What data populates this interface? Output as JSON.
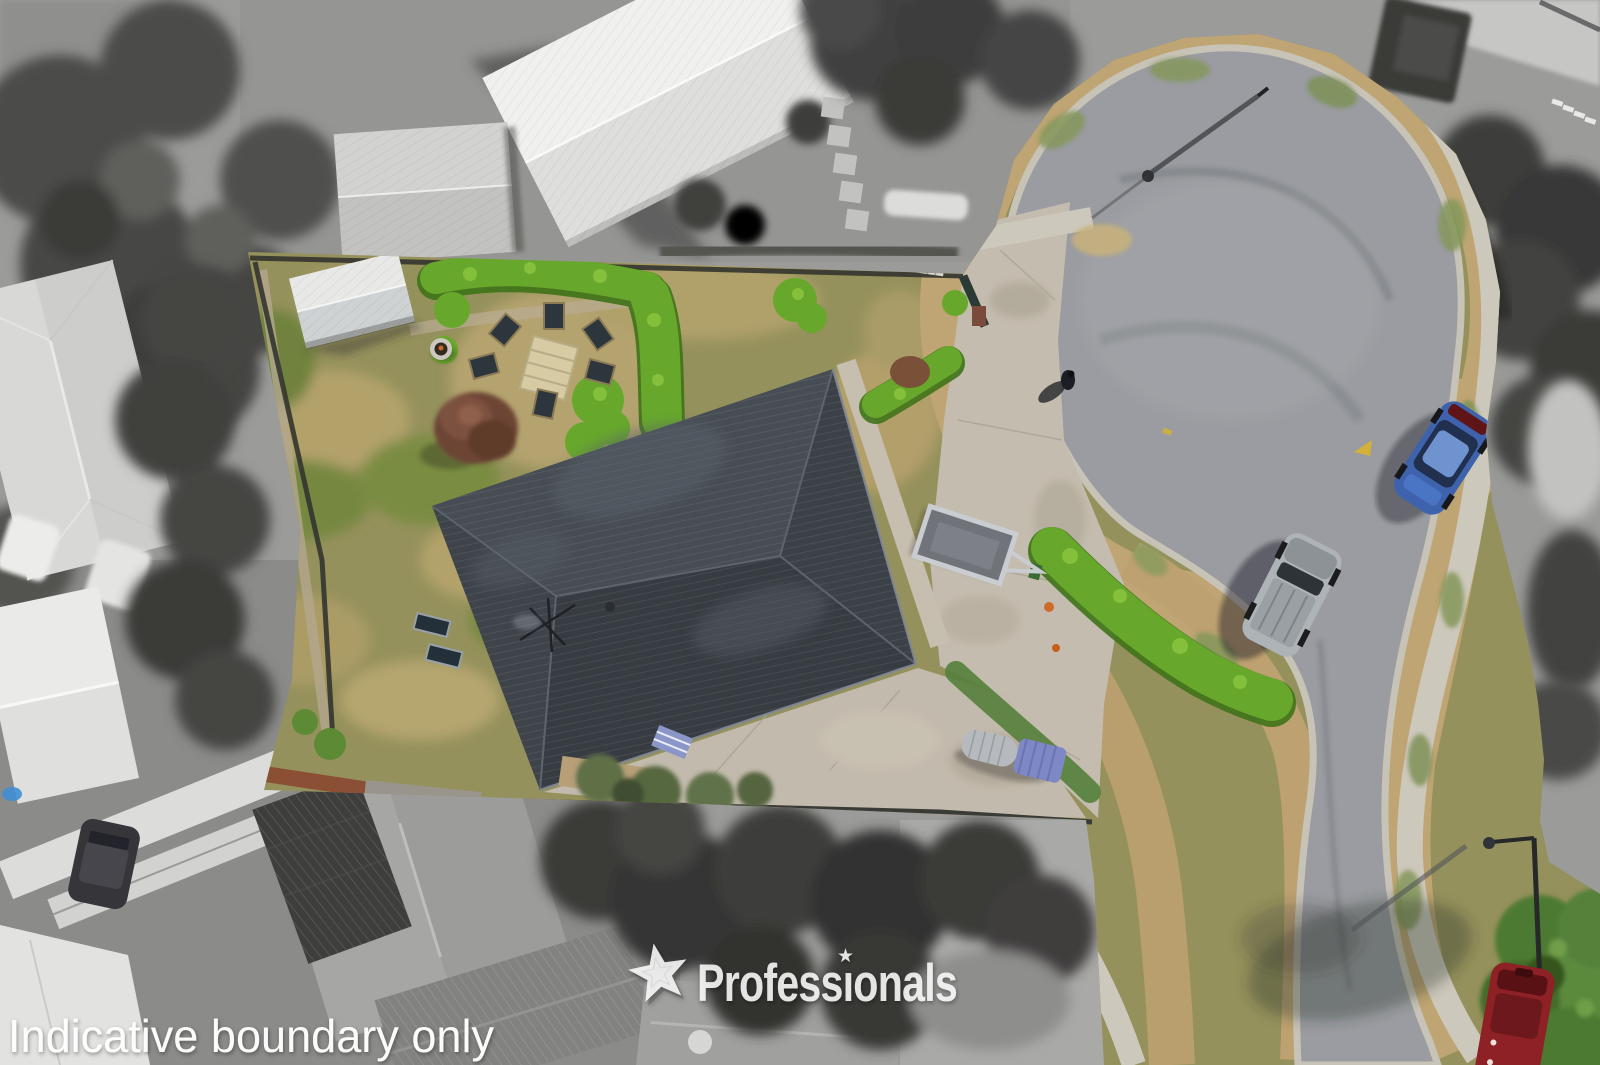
{
  "watermark": {
    "brand": "Professionals",
    "star_icon": "five-point-star",
    "text_color": "#ffffff",
    "opacity": 0.85
  },
  "caption": {
    "text": "Indicative boundary only",
    "text_color": "#ffffff"
  },
  "palette": {
    "house_roof": "#41464d",
    "road_asphalt": "#9a9ca1",
    "lawn": "#95915c",
    "hedge_green": "#67a82c",
    "grass_verge": "#bfa573",
    "concrete_driveway": "#c4bcae",
    "footpath": "#cdc8bc",
    "blue_car": "#3e63ac",
    "silver_car": "#aeb3b7",
    "red_car": "#8e2125",
    "grayscale_base": "#9b9b99"
  }
}
